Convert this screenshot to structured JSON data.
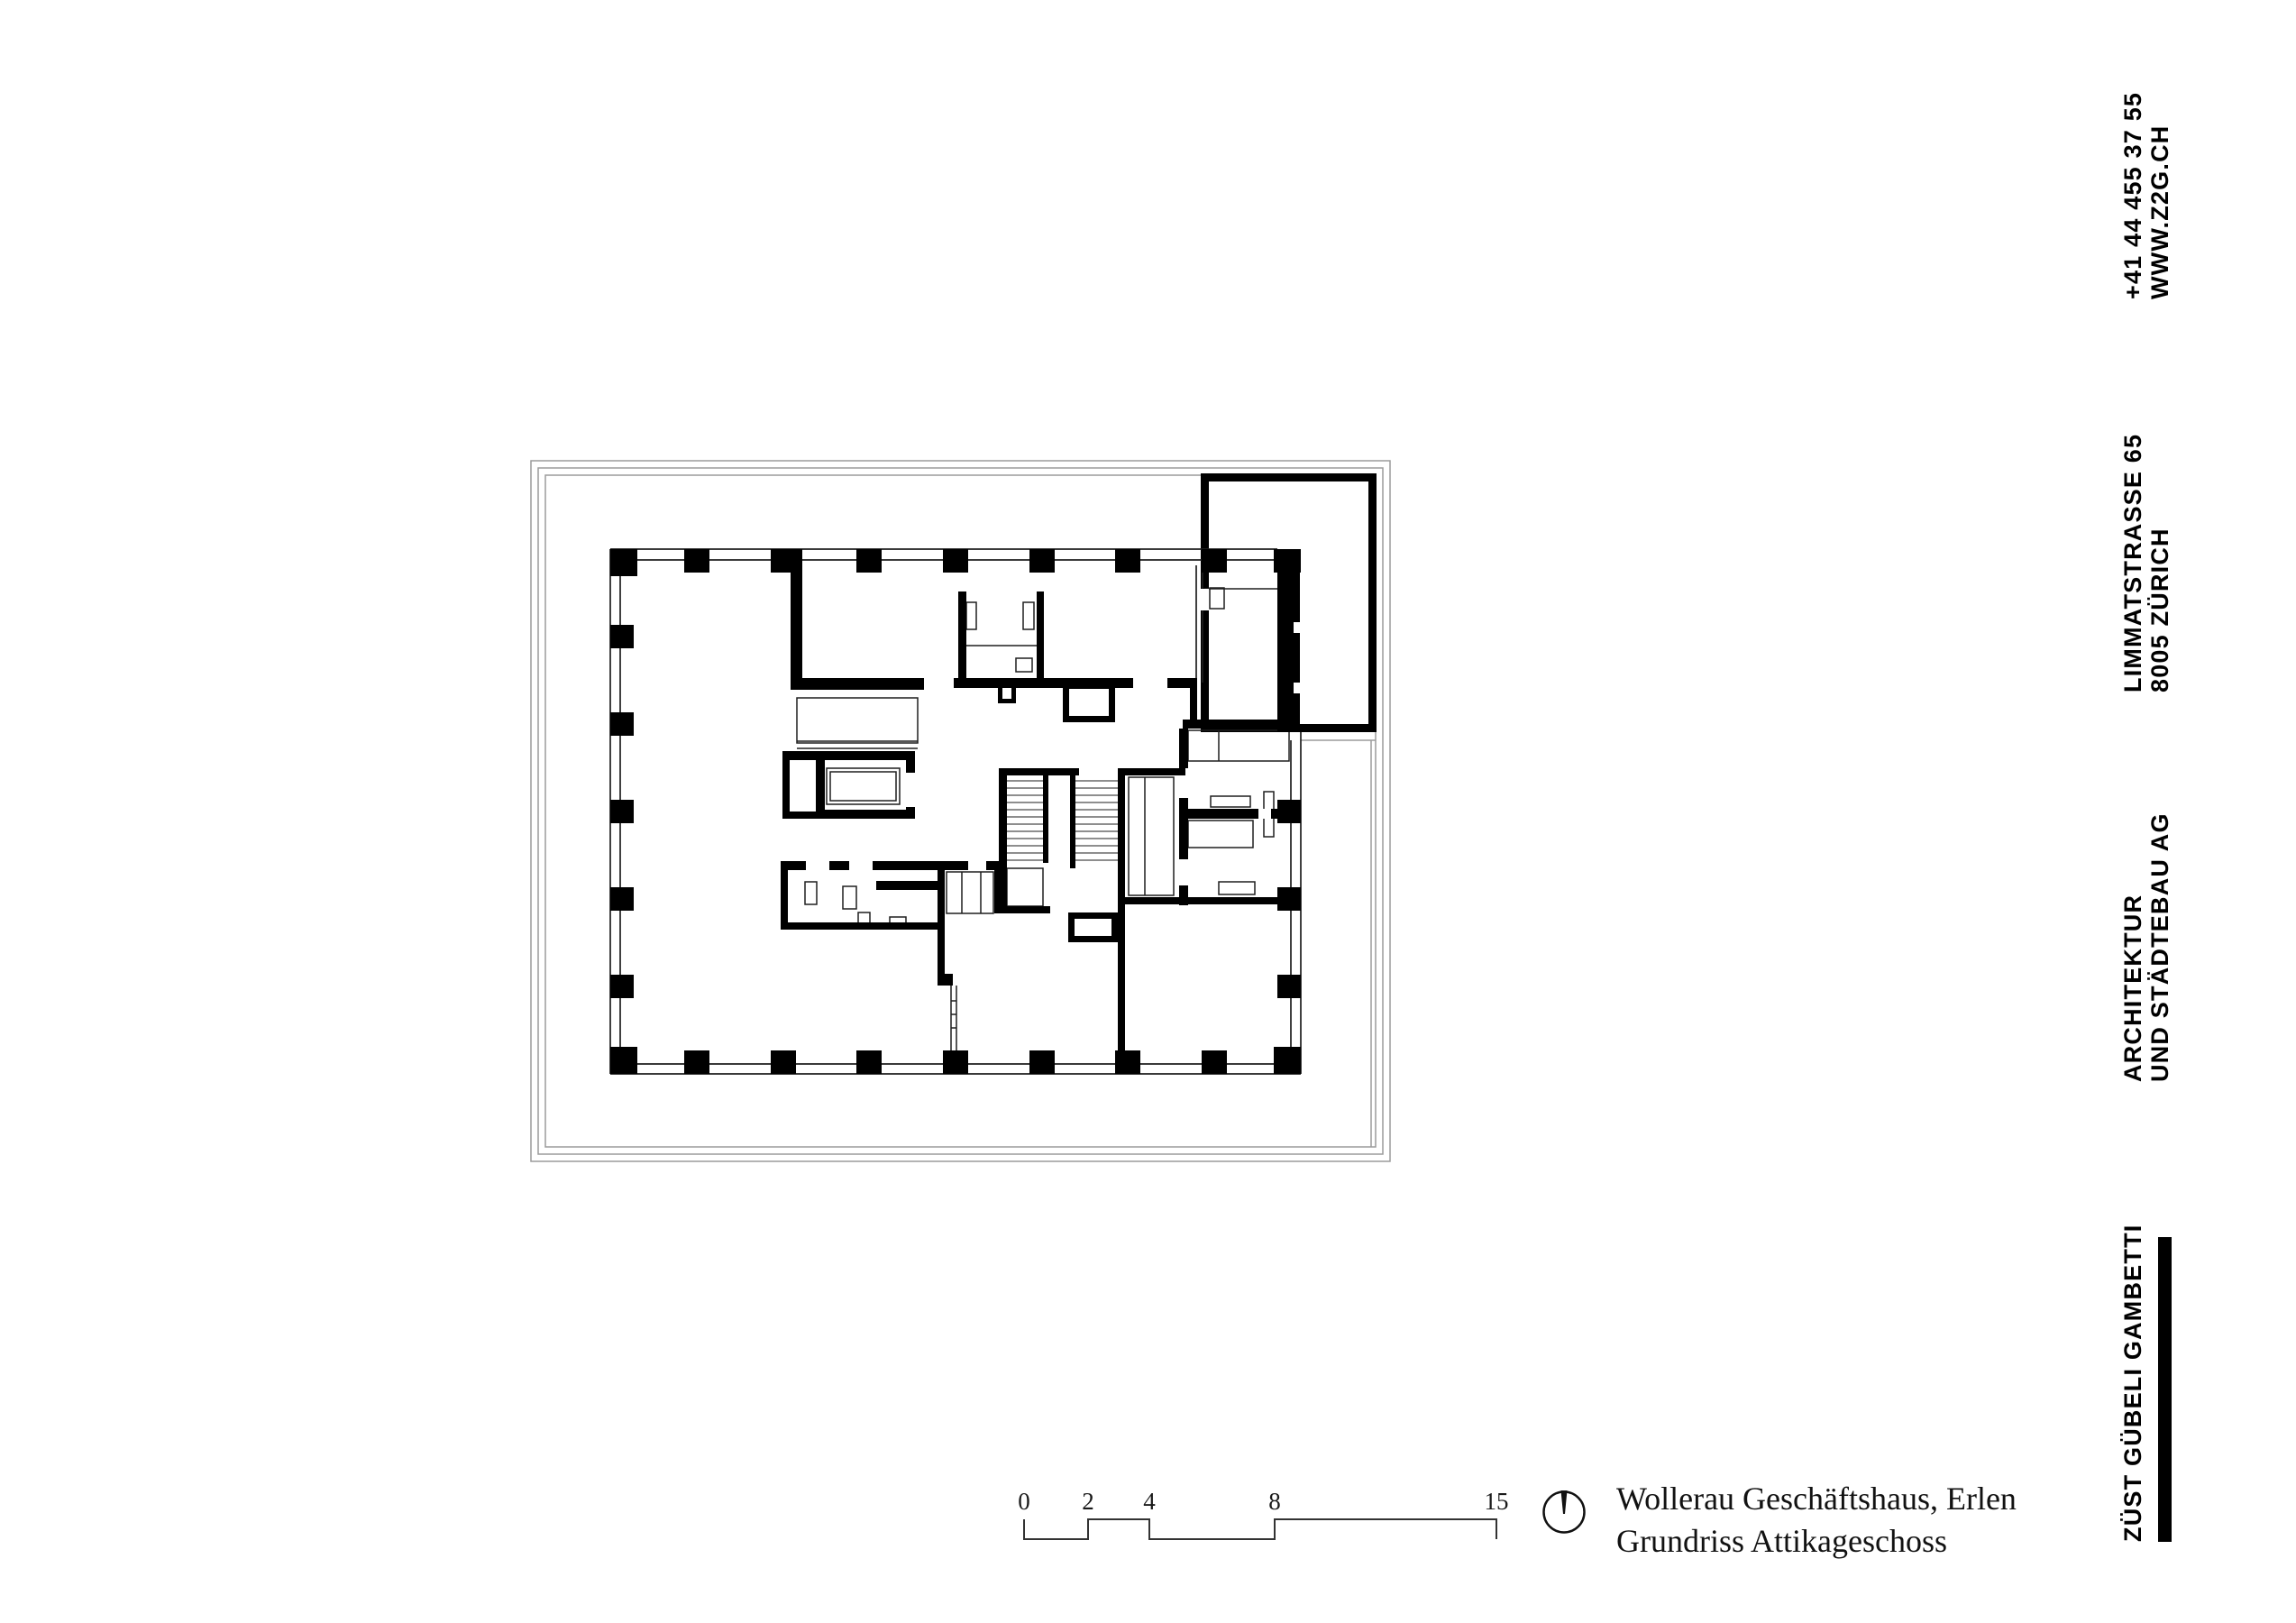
{
  "meta": {
    "background": "#ffffff",
    "ink": "#000000",
    "wall_color": "#000000",
    "terrace_line_color": "#9b9b9b"
  },
  "sidebar": {
    "contact": {
      "line1": "+41 44 455 37 55",
      "line2": "WWW.Z2G.CH"
    },
    "address": {
      "line1": "LIMMATSTRASSE 65",
      "line2": "8005 ZÜRICH"
    },
    "firm": {
      "line1": "ARCHITEKTUR",
      "line2": "UND STÄDTEBAU AG"
    },
    "brand": {
      "name": "ZÜST GÜBELI GAMBETTI"
    }
  },
  "titleblock": {
    "line1": "Wollerau Geschäftshaus, Erlen",
    "line2": "Grundriss Attikageschoss"
  },
  "scalebar": {
    "labels": [
      "0",
      "2",
      "4",
      "8",
      "15"
    ],
    "unit_pixels_per_meter": 35
  },
  "drawing": {
    "name": "floor-plan-attic",
    "north_arrow_icon": "north-arrow-icon"
  }
}
